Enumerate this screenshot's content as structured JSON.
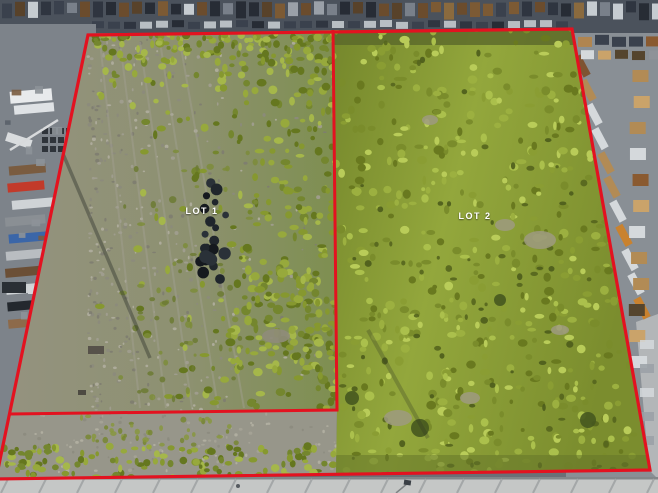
{
  "lots": [
    {
      "id": "lot-1",
      "label": "LOT 1"
    },
    {
      "id": "lot-2",
      "label": "LOT 2"
    }
  ],
  "annotation": {
    "boundary_color": "#e31220",
    "label_color": "#ffffff"
  }
}
